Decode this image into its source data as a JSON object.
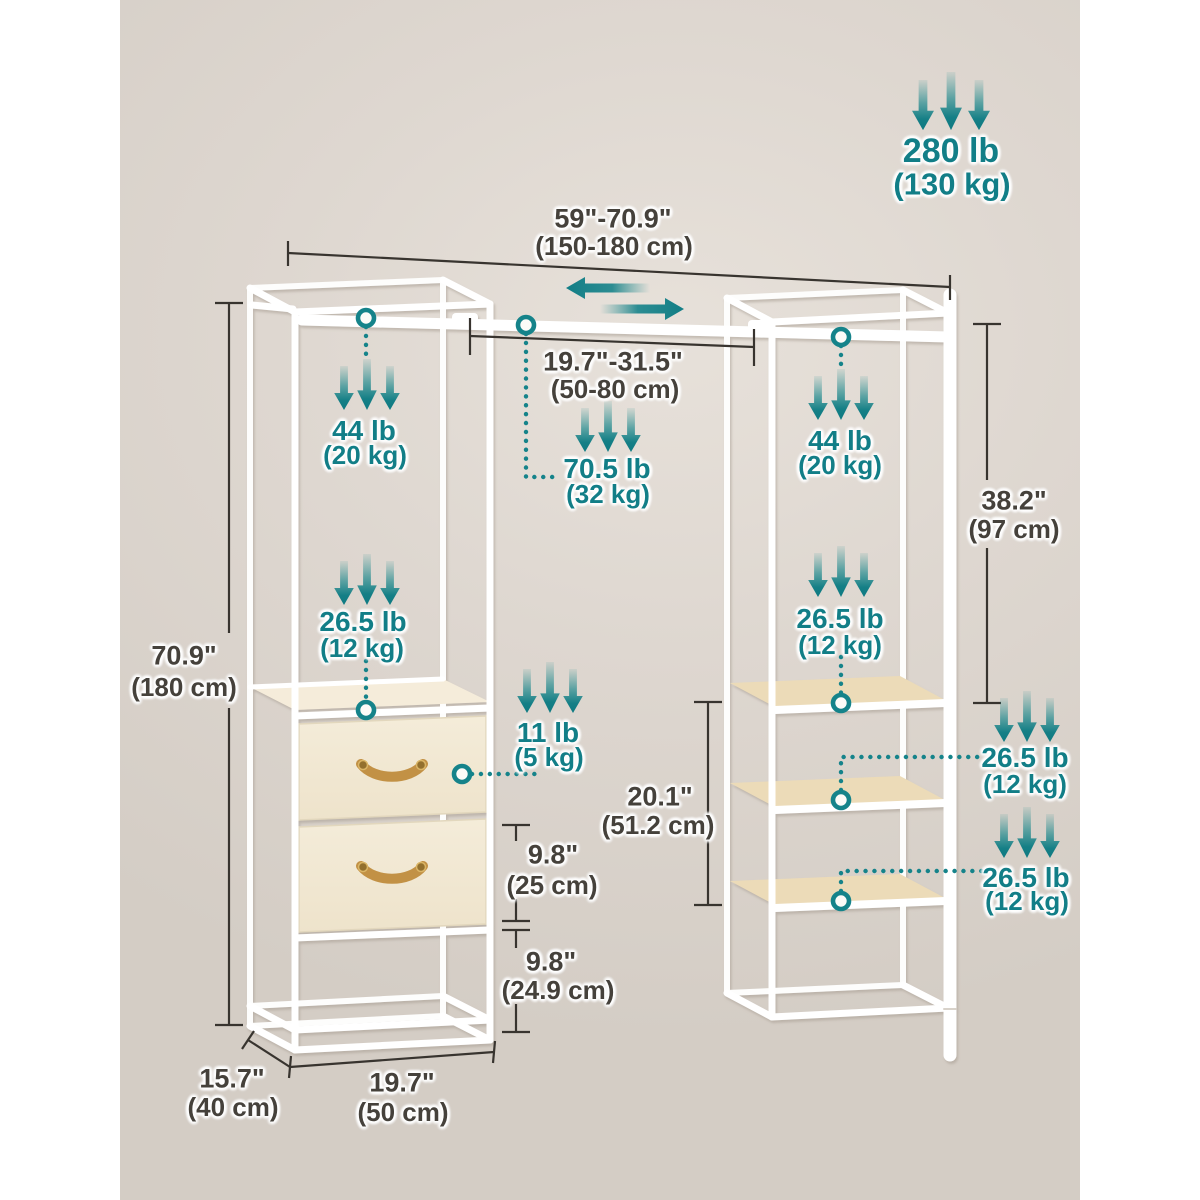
{
  "diagram_title": "expandable-garment-rack-dimension-diagram",
  "colors": {
    "teal_accent": "#15828A",
    "dark_text": "#45413B",
    "background_beige": "#DCD5CD",
    "frame_white": "#FFFFFF",
    "drawer_fabric": "#F1E8D3",
    "handle_gold": "#C29145",
    "shelf_wood": "#ECDBB8"
  },
  "capacities": {
    "total": {
      "lb": "280 lb",
      "kg": "(130 kg)"
    },
    "rod_left": {
      "lb": "44 lb",
      "kg": "(20 kg)"
    },
    "rod_middle": {
      "lb": "70.5 lb",
      "kg": "(32 kg)"
    },
    "rod_right": {
      "lb": "44 lb",
      "kg": "(20 kg)"
    },
    "left_top": {
      "lb": "26.5 lb",
      "kg": "(12 kg)"
    },
    "shelf_top": {
      "lb": "26.5 lb",
      "kg": "(12 kg)"
    },
    "shelf_middle": {
      "lb": "26.5 lb",
      "kg": "(12 kg)"
    },
    "shelf_bottom": {
      "lb": "26.5 lb",
      "kg": "(12 kg)"
    },
    "drawer": {
      "lb": "11 lb",
      "kg": "(5 kg)"
    }
  },
  "dimensions": {
    "overall_width": {
      "in": "59\"-70.9\"",
      "cm": "(150-180 cm)"
    },
    "middle_rod_width": {
      "in": "19.7\"-31.5\"",
      "cm": "(50-80 cm)"
    },
    "overall_height": {
      "in": "70.9\"",
      "cm": "(180 cm)"
    },
    "rod_height": {
      "in": "38.2\"",
      "cm": "(97 cm)"
    },
    "shelf_section_height": {
      "in": "20.1\"",
      "cm": "(51.2 cm)"
    },
    "drawer_height": {
      "in": "9.8\"",
      "cm": "(25 cm)"
    },
    "clearance_height": {
      "in": "9.8\"",
      "cm": "(24.9 cm)"
    },
    "depth": {
      "in": "15.7\"",
      "cm": "(40 cm)"
    },
    "tower_width": {
      "in": "19.7\"",
      "cm": "(50 cm)"
    }
  }
}
